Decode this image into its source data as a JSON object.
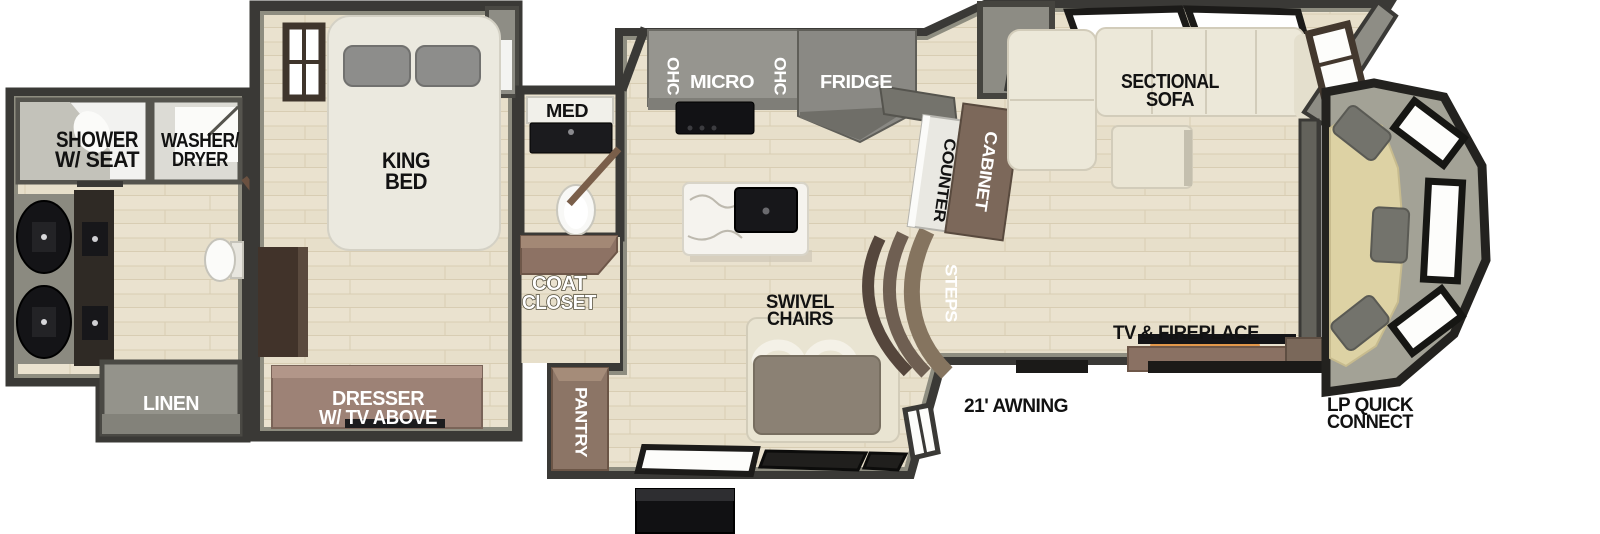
{
  "labels": {
    "shower_line1": "SHOWER",
    "shower_line2": "W/ SEAT",
    "washer_line1": "WASHER/",
    "washer_line2": "DRYER",
    "linen": "LINEN",
    "king_line1": "KING",
    "king_line2": "BED",
    "dresser_line1": "DRESSER",
    "dresser_line2": "W/ TV ABOVE",
    "med": "MED",
    "coat_line1": "COAT",
    "coat_line2": "CLOSET",
    "ohc_left": "OHC",
    "micro": "MICRO",
    "ohc_right": "OHC",
    "fridge": "FRIDGE",
    "pantry": "PANTRY",
    "swivel_line1": "SWIVEL",
    "swivel_line2": "CHAIRS",
    "steps": "STEPS",
    "counter": "COUNTER",
    "cabinet": "CABINET",
    "sofa_line1": "SECTIONAL",
    "sofa_line2": "SOFA",
    "tv_fireplace": "TV & FIREPLACE",
    "awning": "21' AWNING",
    "lp_line1": "LP QUICK",
    "lp_line2": "CONNECT"
  },
  "colors": {
    "wall_dark": "#3a3936",
    "wall_inner": "#8e8d80",
    "floor_wood": "#e7dfca",
    "floor_line": "#d8cdb3",
    "cabinet_brown": "#8d7668",
    "dresser_brown": "#9d8276",
    "counter_gray": "#96958f",
    "fridge_gray": "#8a8984",
    "fixture_black": "#17171a",
    "sofa_cream": "#ece8d9",
    "seat_tan": "#ddd2a4",
    "pillow_gray": "#73736c",
    "fire_glow": "#e2903c",
    "label_black": "#121212",
    "label_white": "#ffffff"
  }
}
